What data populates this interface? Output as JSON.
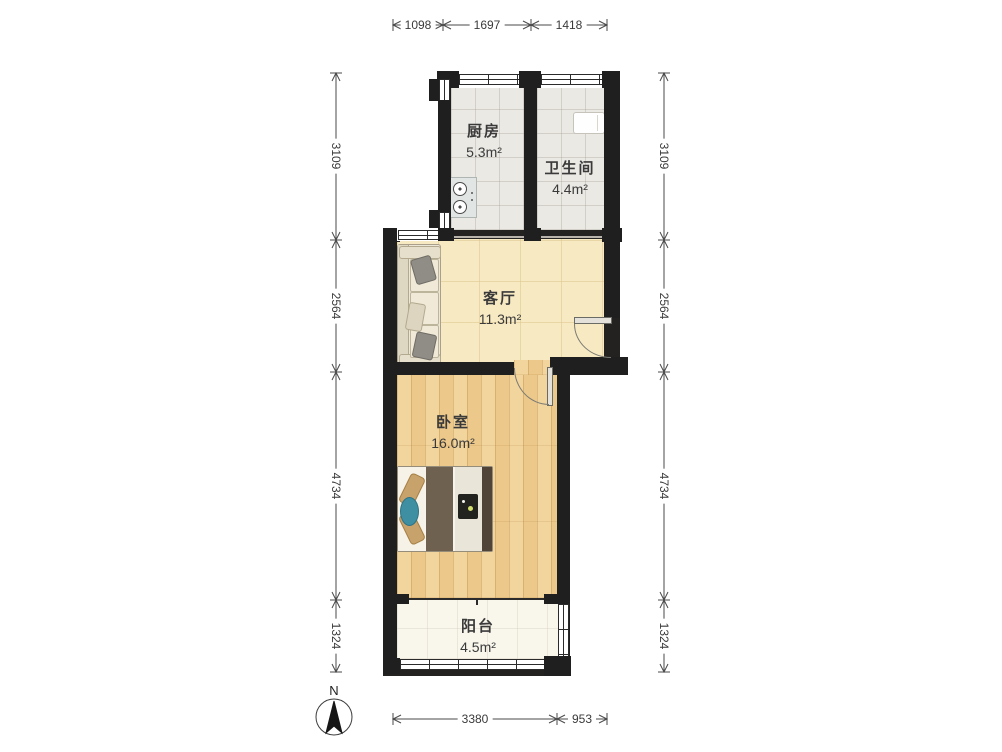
{
  "rooms": [
    {
      "id": "kitchen",
      "name": "厨房",
      "area": "5.3m²"
    },
    {
      "id": "bathroom",
      "name": "卫生间",
      "area": "4.4m²"
    },
    {
      "id": "living_room",
      "name": "客厅",
      "area": "11.3m²"
    },
    {
      "id": "bedroom",
      "name": "卧室",
      "area": "16.0m²"
    },
    {
      "id": "balcony",
      "name": "阳台",
      "area": "4.5m²"
    }
  ],
  "dimensions_mm": {
    "top": [
      "1098",
      "1697",
      "1418"
    ],
    "left": [
      "3109",
      "2564",
      "4734",
      "1324"
    ],
    "right": [
      "3109",
      "2564",
      "4734",
      "1324"
    ],
    "bottom": [
      "3380",
      "953"
    ]
  },
  "compass": {
    "label": "N"
  },
  "colors": {
    "wall": "#1f1f1f",
    "kitchen_bath_floor": "#ebe9e4",
    "living_floor": "#f7e9c2",
    "bedroom_floor": "#f1cf92",
    "balcony_floor": "#f9f7ec",
    "dimension_text": "#3a3a3a",
    "bed_accent": "#3f8fa3"
  }
}
